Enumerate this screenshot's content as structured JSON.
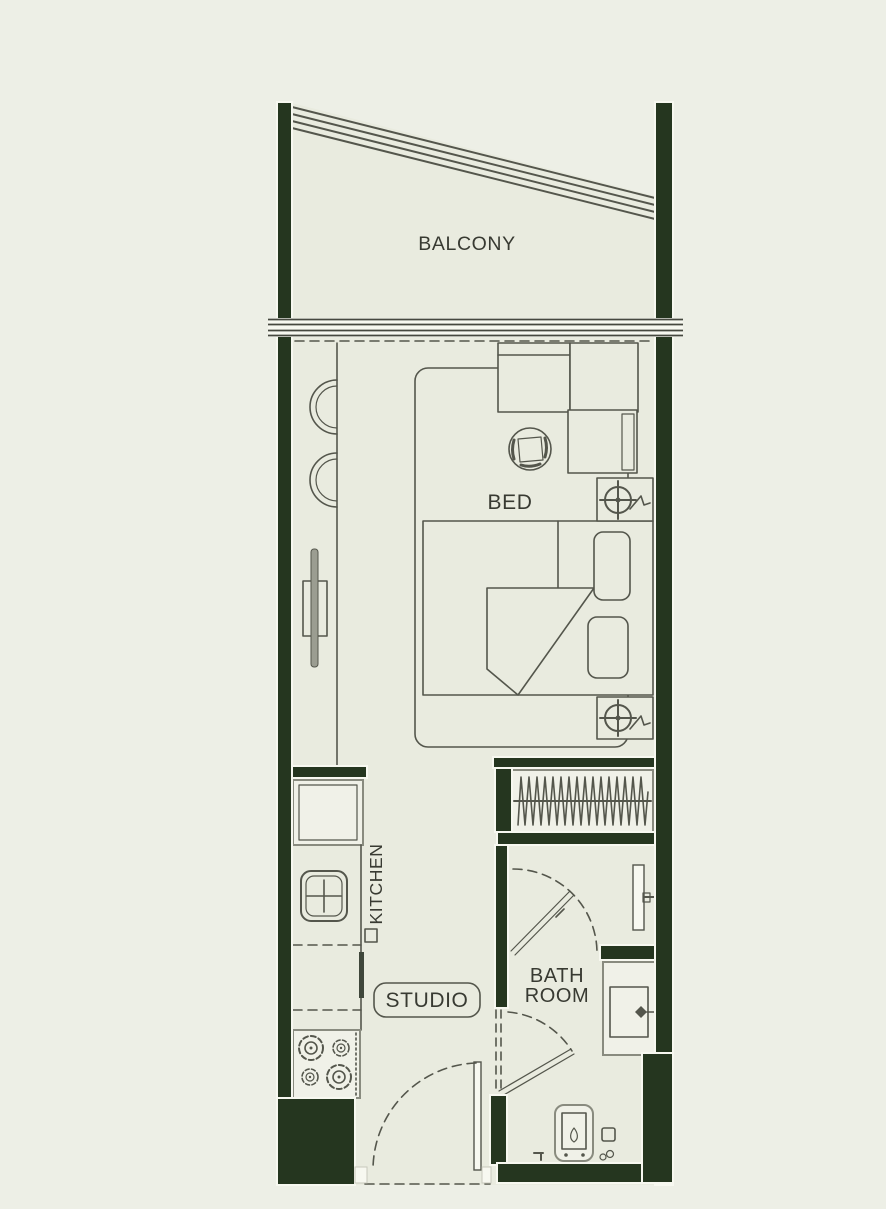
{
  "colors": {
    "background": "#edefe6",
    "floor": "#e9ebdf",
    "wall": "#25361f",
    "line": "#54564c",
    "edge": "#f7f8f0",
    "boxfill": "#f0f1e8",
    "boxline": "#898b7f",
    "text": "#383a32"
  },
  "plan": {
    "type": "studio-apartment-floor-plan",
    "rooms": {
      "balcony": {
        "label": "BALCONY"
      },
      "bed_area": {
        "label": "BED"
      },
      "kitchen": {
        "label": "KITCHEN"
      },
      "studio": {
        "label": "STUDIO"
      },
      "bathroom": {
        "label_line1": "BATH",
        "label_line2": "ROOM"
      }
    }
  }
}
